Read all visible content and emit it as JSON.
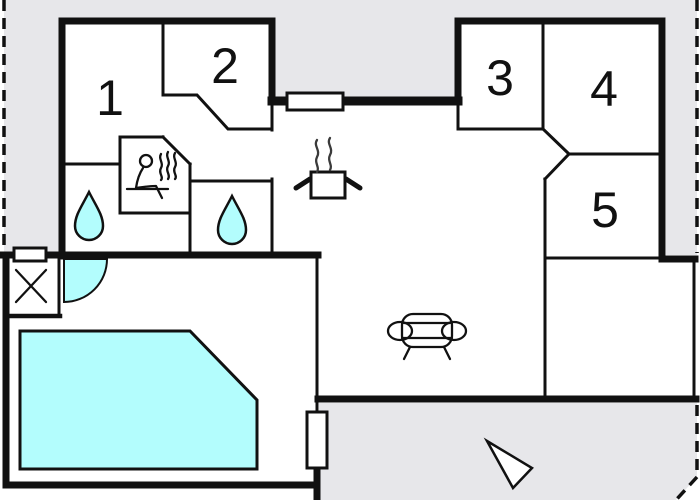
{
  "colors": {
    "background": "#ffffff",
    "ground": "#e7e7ea",
    "wall": "#111111",
    "water": "#b3fdfd"
  },
  "rooms": [
    {
      "number": "1"
    },
    {
      "number": "2"
    },
    {
      "number": "3"
    },
    {
      "number": "4"
    },
    {
      "number": "5"
    }
  ],
  "symbols": {
    "sauna": "sauna-person-icon",
    "shower_left": "water-drop-icon",
    "shower_right": "water-drop-icon",
    "stove": "stove-pot-icon",
    "sofa": "sofa-icon",
    "pool": "swimming-pool",
    "door_swing": "door-swing-arc",
    "utility": "cross-marker-icon",
    "north_arrow": "north-arrow-icon",
    "boundary": "property-line-dashed"
  }
}
